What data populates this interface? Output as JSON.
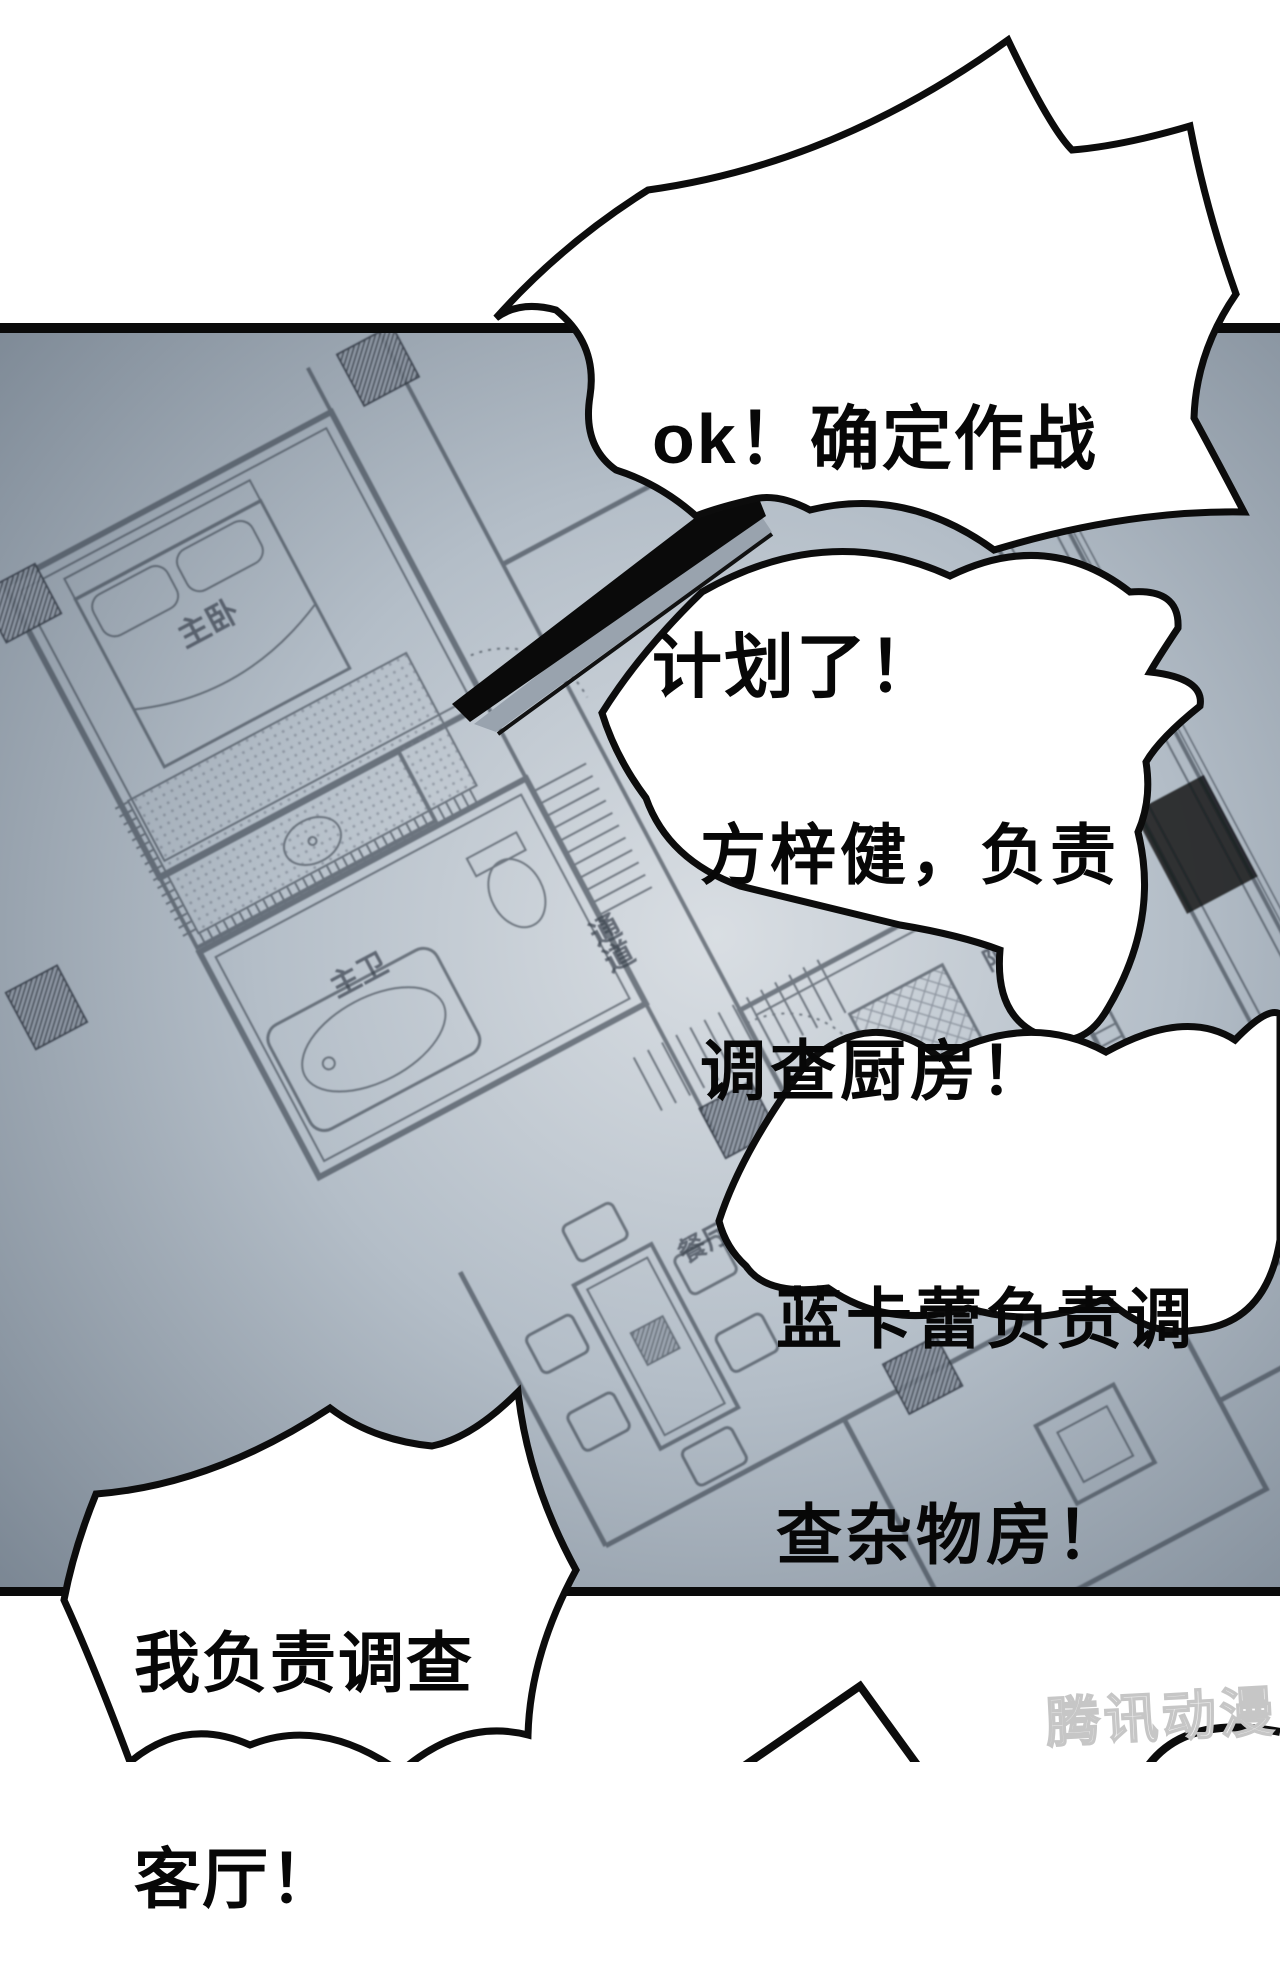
{
  "page": {
    "type": "comic-page",
    "source": "webtoon"
  },
  "bubbles": [
    {
      "name": "plan-confirmed",
      "lines": [
        "ok！确定作战",
        "计划了！"
      ]
    },
    {
      "name": "kitchen-assignment",
      "lines": [
        "方梓健，负责",
        "调查厨房！"
      ]
    },
    {
      "name": "storage-room-assignment",
      "lines": [
        "蓝卡蕾负责调",
        "查杂物房！"
      ]
    },
    {
      "name": "living-room-assignment",
      "lines": [
        "我负责调查",
        "客厅！"
      ]
    }
  ],
  "floor_plan": {
    "labels": {
      "balcony_2": "阳台2",
      "master_bedroom": "主卧",
      "master_bathroom": "主卫",
      "corridor": "通道",
      "dining_room": "餐厅",
      "balcony": "阳台"
    }
  },
  "watermark": {
    "text": "腾讯动漫"
  },
  "colors": {
    "panel_edge": "#76828f",
    "panel_mid": "#aab4bf",
    "panel_center": "#d9dee3",
    "blueprint_line": "#39414c",
    "ink": "#0c0c0c",
    "watermark_gray": "#c9c9c9"
  }
}
